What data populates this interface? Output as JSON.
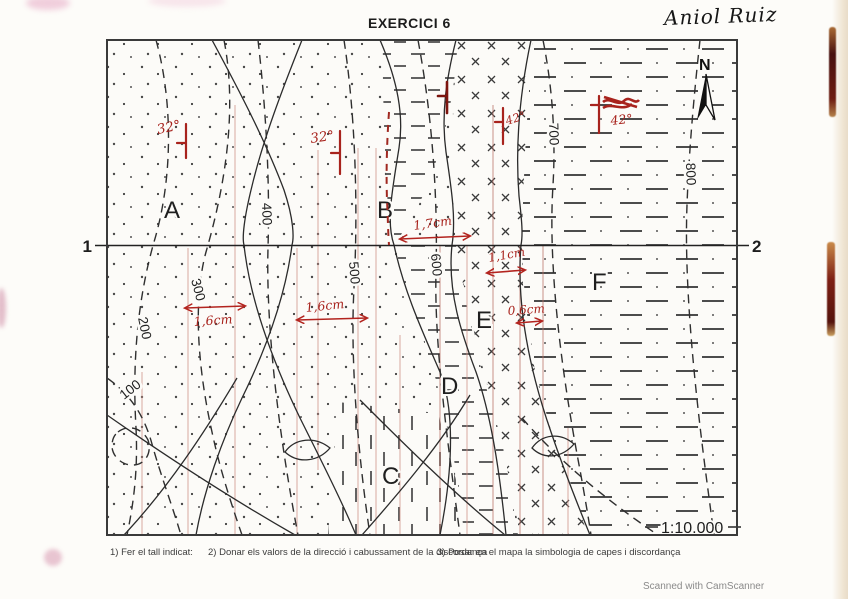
{
  "page": {
    "title": "EXERCICI 6",
    "author": "Aniol Ruiz",
    "scanner": "Scanned with CamScanner"
  },
  "map": {
    "scale": "1:10.000",
    "north": "N",
    "section": {
      "left": "1",
      "right": "2"
    },
    "zone_labels": {
      "a": "A",
      "b": "B",
      "c": "C",
      "d": "D",
      "e": "E",
      "f": "F"
    },
    "contour_labels": {
      "c100": "100",
      "c200": "200",
      "c300": "300",
      "c400": "400",
      "c500": "500",
      "c600": "600",
      "c700": "700",
      "c800": "800"
    },
    "annotations": {
      "dip_a": "32°",
      "dip_b": "32°",
      "dip_e": "42°",
      "dip_f": "42°",
      "dist_a": "1,6cm",
      "dist_b": "1,6cm",
      "dist_bc": "1,7cm",
      "dist_e": "1,1cm",
      "dist_f": "0,6cm"
    }
  },
  "footer": {
    "task1": "1) Fer el tall indicat:",
    "task2": "2) Donar els valors de la direcció i cabussament de la discordança",
    "task3": "3) Posar en el mapa la simbologia de capes i discordança"
  },
  "colors": {
    "annotation_red": "#a8231d",
    "ink": "#2b2b2b"
  }
}
